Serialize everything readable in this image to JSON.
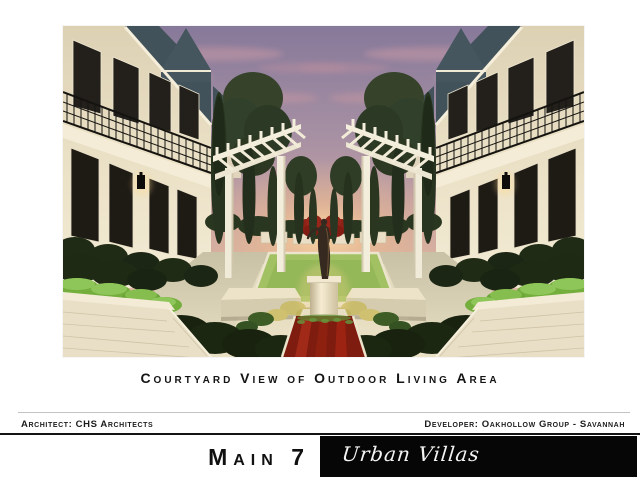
{
  "caption": "Courtyard View of Outdoor Living Area",
  "credits": {
    "architect_label": "Architect: CHS Architects",
    "developer_label": "Developer: Oakhollow Group - Savannah"
  },
  "banner": {
    "project_name": "Main 7",
    "subtitle": "Urban Villas"
  },
  "rendering": {
    "scene": "courtyard-view-of-outdoor-living-area-at-dusk",
    "elements": [
      "townhome-left",
      "townhome-right",
      "pergola-left",
      "pergola-right",
      "cypress-trees",
      "shade-trees",
      "central-statue",
      "statue-pedestal",
      "lawn-pool-panel",
      "red-flower-bed",
      "boxwood-hedges",
      "white-brick-planters",
      "wall-lanterns",
      "sunset-sky"
    ]
  },
  "colors": {
    "page_background": "#ffffff",
    "banner_background": "#060606",
    "text_primary": "#141414",
    "sky_top": "#87799a",
    "sky_glow": "#ffd9a0",
    "building_cream": "#ece2c9",
    "roof_slate": "#45555d",
    "foliage_dark": "#1d2814",
    "lawn_green": "#a2c163",
    "flower_red": "#9e2818"
  }
}
